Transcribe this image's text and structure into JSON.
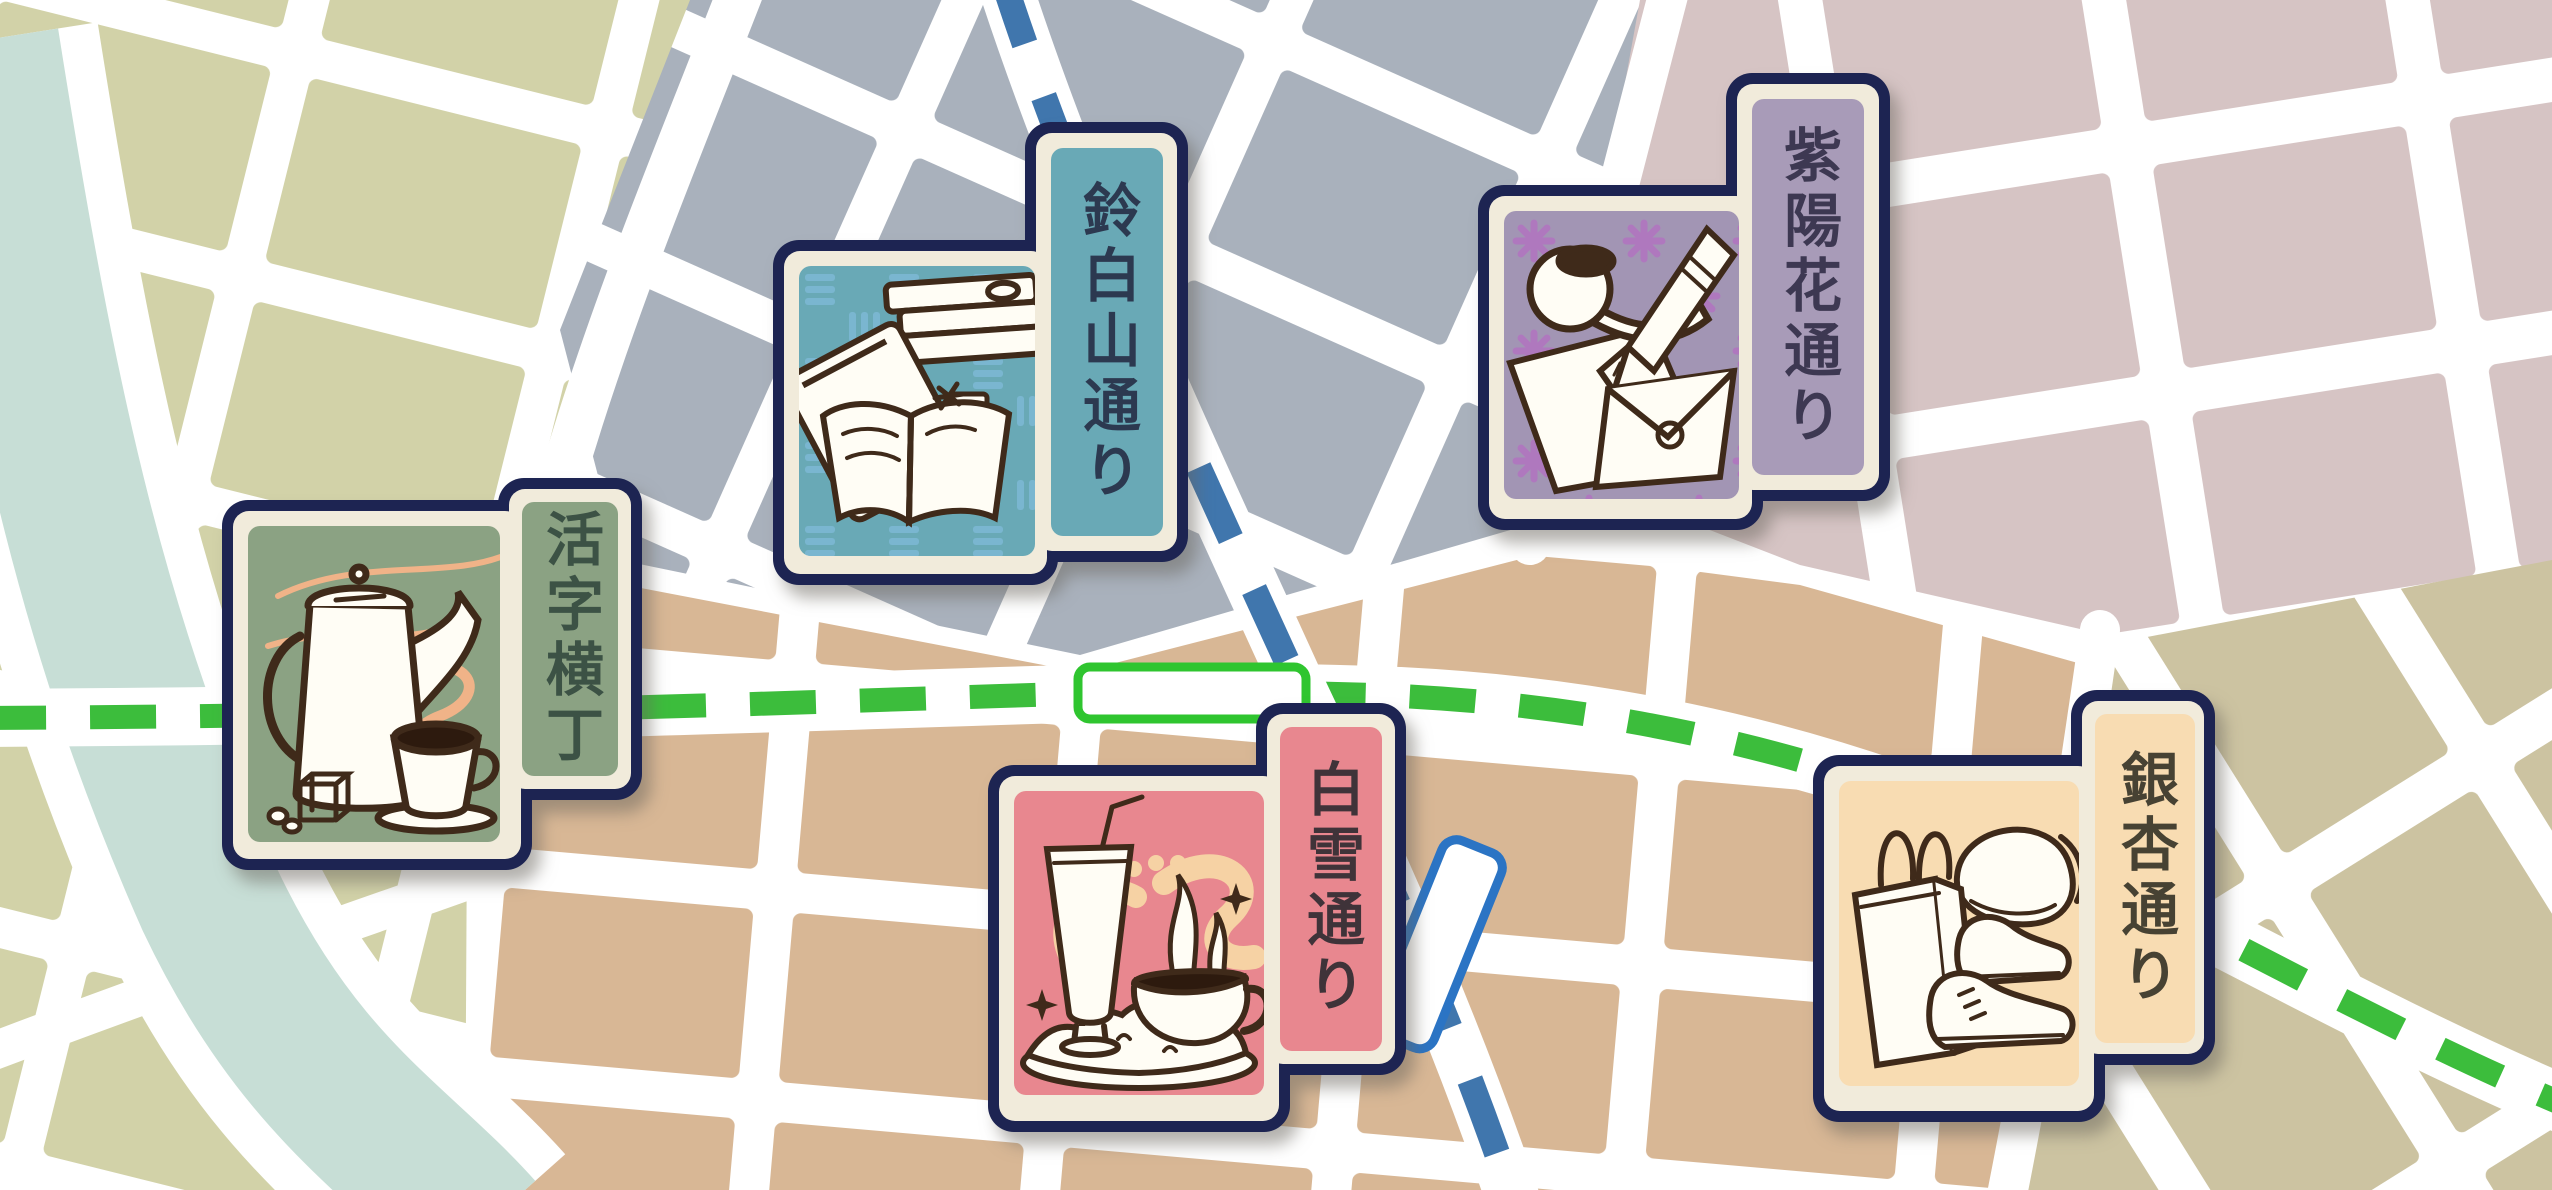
{
  "map": {
    "name": "illustrated-town-map",
    "street_color": "#ffffff",
    "river_color": "#c7ded6",
    "districts": [
      {
        "name": "west-olive-blocks",
        "color": "#d2d2a8"
      },
      {
        "name": "north-gray-blocks",
        "color": "#a9b1bc"
      },
      {
        "name": "northeast-mauve-blocks",
        "color": "#d6c4c4"
      },
      {
        "name": "central-tan-blocks",
        "color": "#d8b795"
      },
      {
        "name": "southeast-khaki-blocks",
        "color": "#ccc3a1"
      }
    ],
    "transit_lines": [
      {
        "id": "green-line",
        "color": "#3cbd3c",
        "style": "dashed"
      },
      {
        "id": "blue-line",
        "color": "#4076ad",
        "style": "dashed"
      }
    ],
    "stations": [
      {
        "id": "green-line-station",
        "outline": "#2fc52f",
        "fill": "#ffffff"
      },
      {
        "id": "blue-line-station",
        "outline": "#2b74c4",
        "fill": "#ffffff"
      }
    ]
  },
  "card_chrome": {
    "border_color": "#1d2452",
    "frame_color": "#f1ebdb",
    "ink_color": "#3f2a1a",
    "steam_color": "#f0b388"
  },
  "markers": [
    {
      "label": "活字横丁",
      "illustration": "coffee-pot-and-cup",
      "panel_color": "#8ba283",
      "label_bg": "#8ba283",
      "text_color": "#3c5245",
      "pattern_color": null
    },
    {
      "label": "鈴白山通り",
      "illustration": "stacked-and-open-books",
      "panel_color": "#69a9b6",
      "label_bg": "#69a9b6",
      "text_color": "#2c3950",
      "pattern_color": "#7db9d5"
    },
    {
      "label": "紫陽花通り",
      "illustration": "pipe-pen-and-letter",
      "panel_color": "#a295b4",
      "label_bg": "#a89bb8",
      "text_color": "#3d3852",
      "pattern_color": "#b173c0"
    },
    {
      "label": "白雪通り",
      "illustration": "soda-glass-and-curry-rice",
      "panel_color": "#e8878f",
      "label_bg": "#e8878f",
      "text_color": "#3f3339",
      "pattern_color": "#f6d2a4"
    },
    {
      "label": "銀杏通り",
      "illustration": "shopping-bag-hat-and-shoes",
      "panel_color": "#f8dcb2",
      "label_bg": "#f8dcb2",
      "text_color": "#474233",
      "pattern_color": null
    }
  ]
}
